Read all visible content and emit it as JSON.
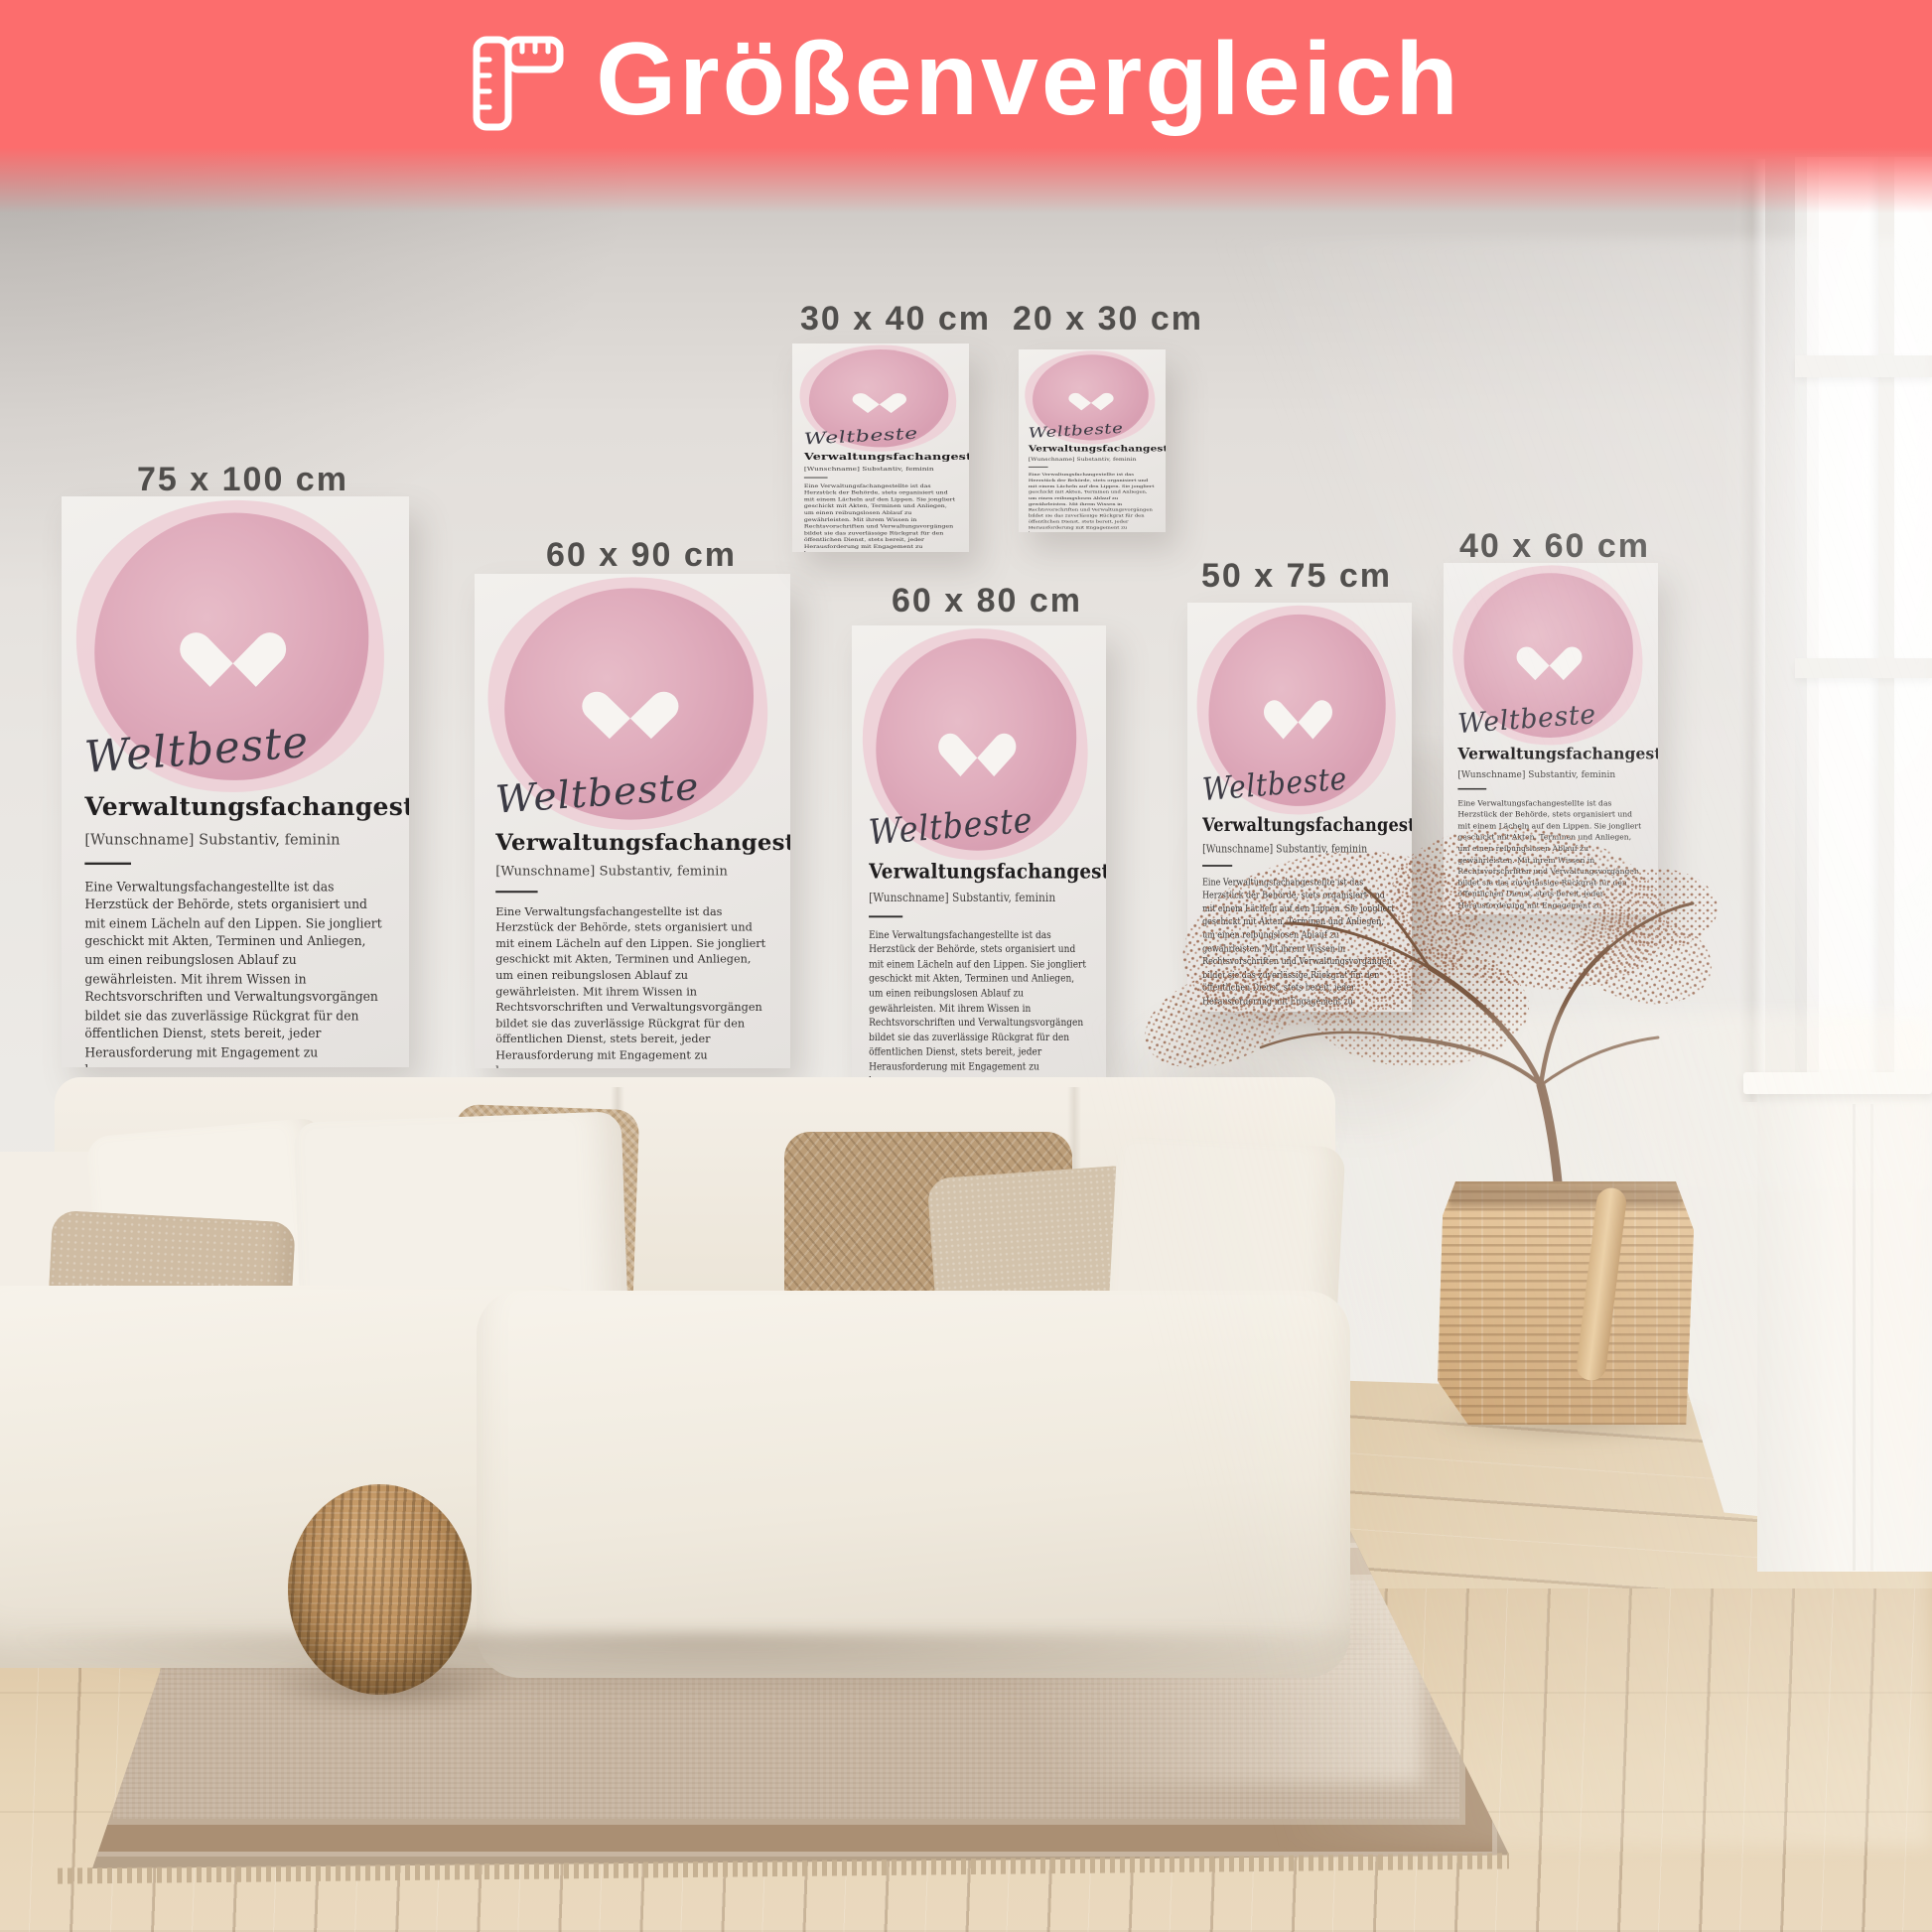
{
  "banner": {
    "title": "Größenvergleich",
    "icon": "ruler-icon",
    "background_color": "#fc6d6d",
    "text_color": "#ffffff"
  },
  "posters": [
    {
      "size_label": "75 x 100 cm"
    },
    {
      "size_label": "60 x 90 cm"
    },
    {
      "size_label": "30 x 40 cm"
    },
    {
      "size_label": "20 x 30 cm"
    },
    {
      "size_label": "60 x 80 cm"
    },
    {
      "size_label": "50 x 75 cm"
    },
    {
      "size_label": "40 x 60 cm"
    }
  ],
  "poster_content": {
    "script_word": "Weltbeste",
    "title": "Verwaltungsfachangestellte",
    "subtitle": "[Wunschname] Substantiv, feminin",
    "body": "Eine Verwaltungsfachangestellte ist das Herzstück der Behörde, stets organisiert und mit einem Lächeln auf den Lippen. Sie jongliert geschickt mit Akten, Terminen und Anliegen, um einen reibungslosen Ablauf zu gewährleisten. Mit ihrem Wissen in Rechtsvorschriften und Verwaltungsvorgängen bildet sie das zuverlässige Rückgrat für den öffentlichen Dienst, stets bereit, jeder Herausforderung mit Engagement zu begegnen.",
    "synonyms_label": "Synonyme:",
    "synonyms": "Büroorganisator, Verwaltungsexperte, Bürokoordinator, Verwaltungsprofi",
    "heart_icon": "heart-icon",
    "watercolor_color": "#e0adbd",
    "label_color": "#454341"
  }
}
